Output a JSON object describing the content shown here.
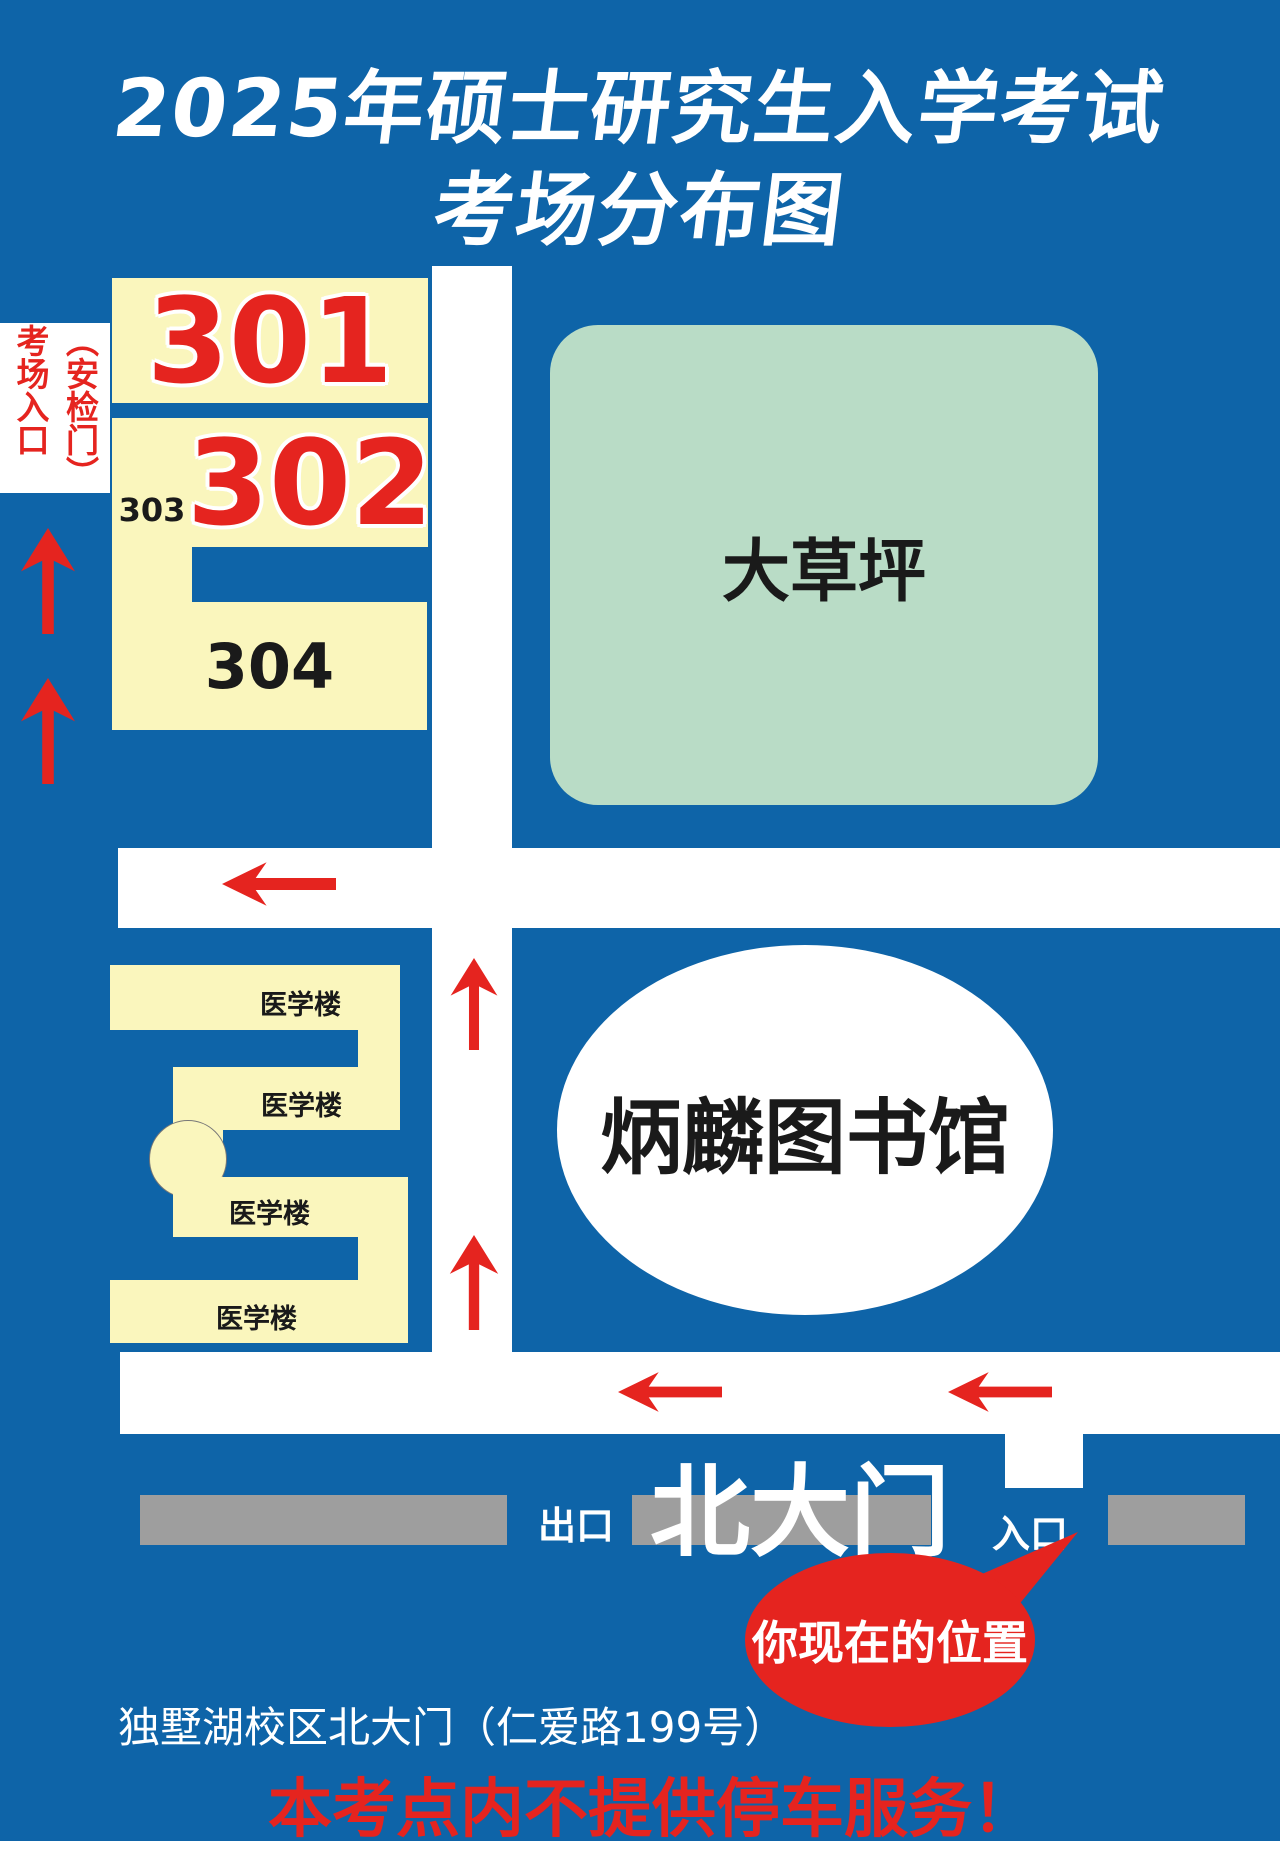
{
  "title": {
    "line1": "2025年硕士研究生入学考试",
    "line2": "考场分布图"
  },
  "security_gate_label": {
    "right_column": "（安检门）",
    "left_column": "考场入口"
  },
  "rooms": {
    "r301": "301",
    "r302": "302",
    "r303": "303",
    "r304": "304"
  },
  "lawn": {
    "label": "大草坪"
  },
  "library": {
    "label": "炳麟图书馆"
  },
  "medical_buildings": {
    "labels": [
      "医学楼",
      "医学楼",
      "医学楼",
      "医学楼"
    ]
  },
  "north_gate": {
    "label": "北大门",
    "exit_label": "出口",
    "entrance_label": "入口"
  },
  "location_bubble": {
    "label": "你现在的位置"
  },
  "address_line": "独墅湖校区北大门（仁爱路199号）",
  "notice_line": "本考点内不提供停车服务！",
  "colors": {
    "background_blue": "#0e64a8",
    "building_yellow": "#faf6bd",
    "lawn_green": "#b9dcc6",
    "accent_red": "#e5241f",
    "road_white": "#ffffff",
    "fence_gray": "#9e9e9e",
    "text_black": "#1a1a1a"
  }
}
